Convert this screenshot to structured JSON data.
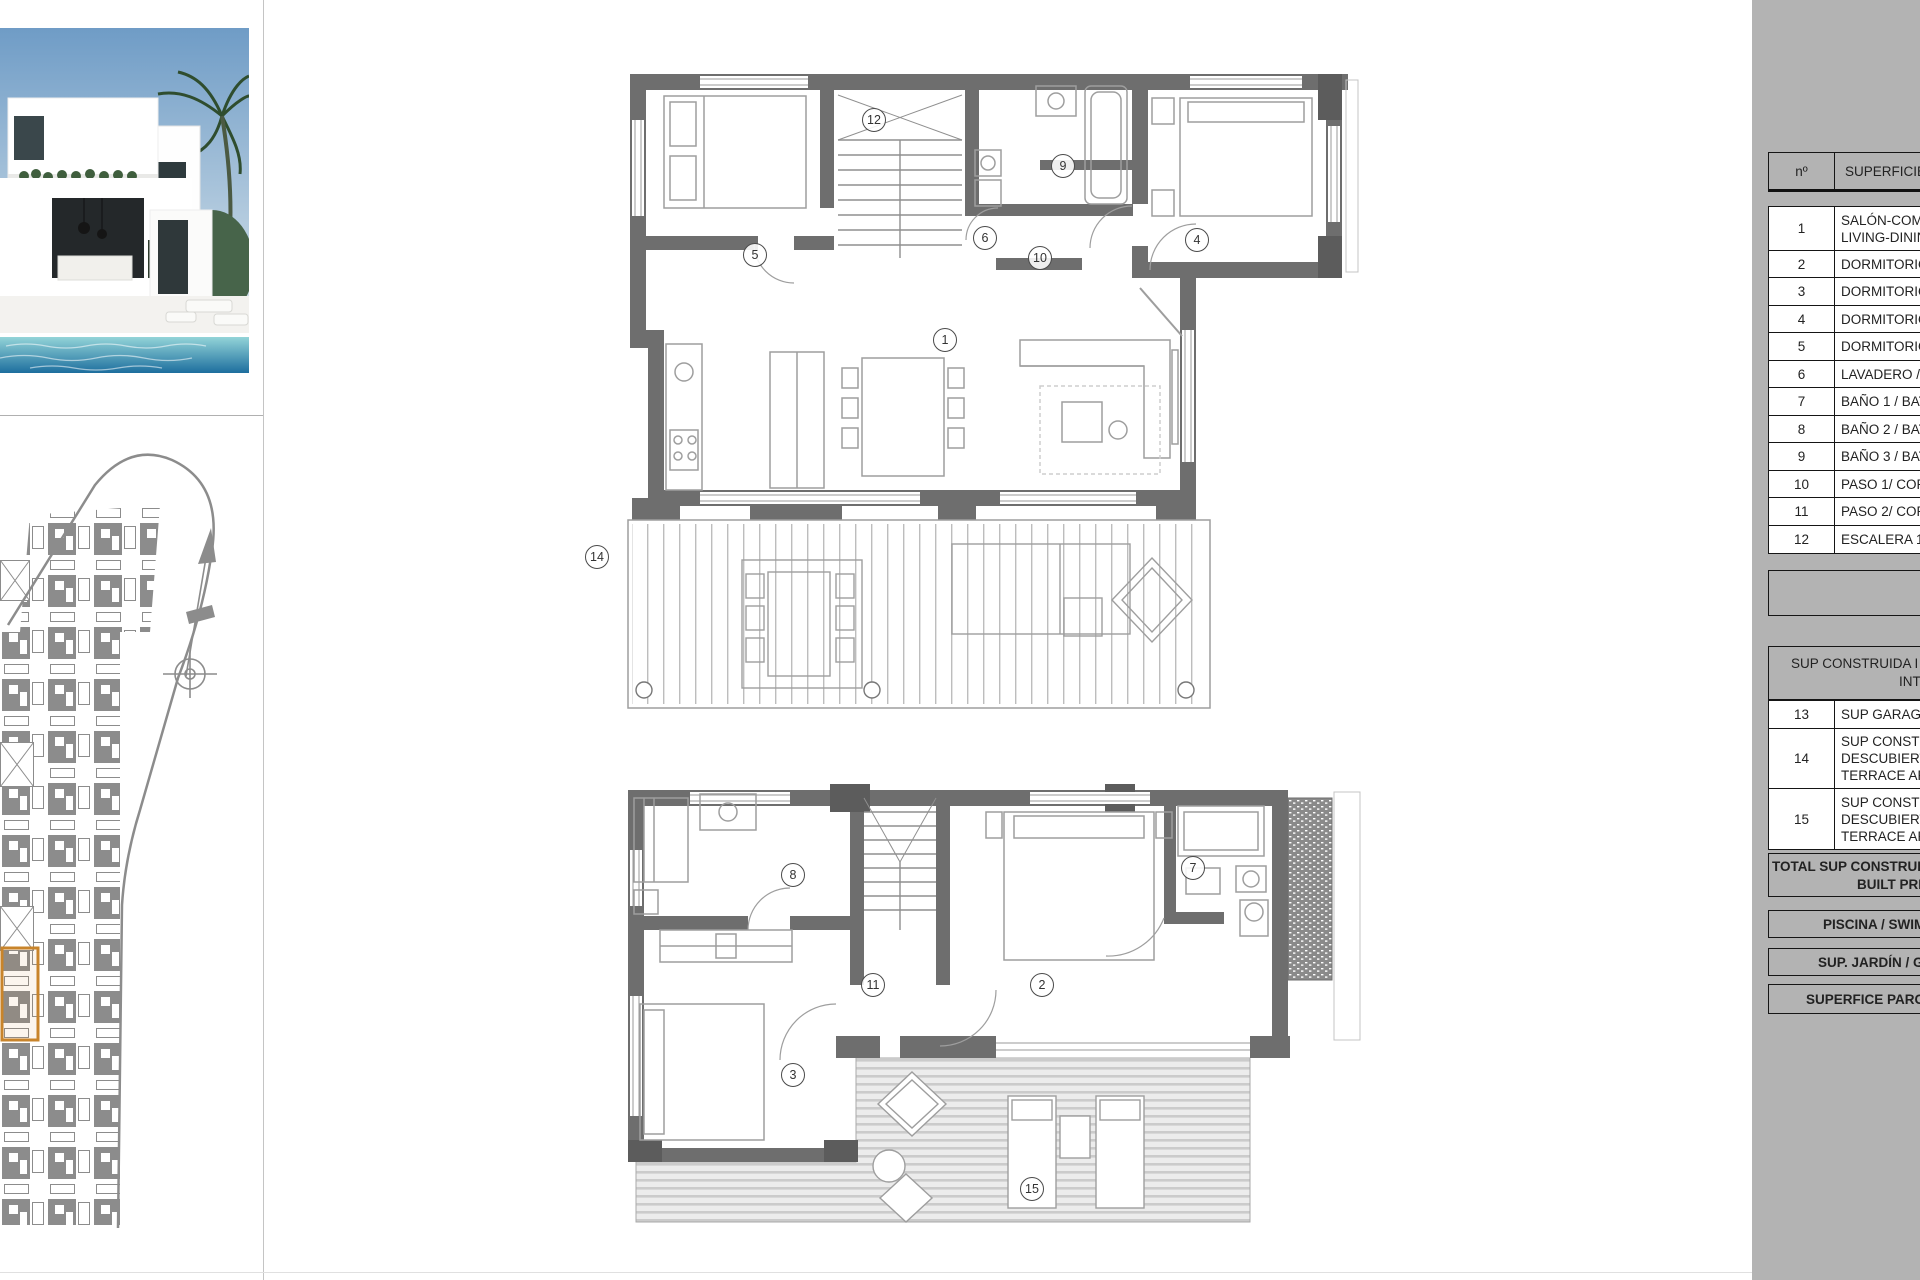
{
  "document": {
    "kind": "architectural plan sheet"
  },
  "photo": {
    "description": "modern white villa render with pool and palm"
  },
  "site_plan": {
    "highlight_color": "#c8842b"
  },
  "plans": {
    "upper": {
      "labels": [
        "12",
        "9",
        "6",
        "10",
        "4",
        "5",
        "1",
        "14"
      ]
    },
    "ground": {
      "labels": [
        "8",
        "7",
        "11",
        "2",
        "3",
        "15"
      ]
    }
  },
  "table": {
    "header": {
      "num": "nº",
      "label": "SUPERFICIE Ú"
    },
    "rooms": [
      {
        "num": "1",
        "lines": [
          "SALÓN-COM",
          "LIVING-DININ"
        ]
      },
      {
        "num": "2",
        "lines": [
          "DORMITORIO"
        ]
      },
      {
        "num": "3",
        "lines": [
          "DORMITORIO"
        ]
      },
      {
        "num": "4",
        "lines": [
          "DORMITORIO"
        ]
      },
      {
        "num": "5",
        "lines": [
          "DORMITORIO"
        ]
      },
      {
        "num": "6",
        "lines": [
          "LAVADERO /"
        ]
      },
      {
        "num": "7",
        "lines": [
          "BAÑO 1 / BAT"
        ]
      },
      {
        "num": "8",
        "lines": [
          "BAÑO 2 / BAT"
        ]
      },
      {
        "num": "9",
        "lines": [
          "BAÑO 3 / BAT"
        ]
      },
      {
        "num": "10",
        "lines": [
          "PASO 1/ COR"
        ]
      },
      {
        "num": "11",
        "lines": [
          "PASO 2/ COR"
        ]
      },
      {
        "num": "12",
        "lines": [
          "ESCALERA 1 /"
        ]
      }
    ],
    "section_header": {
      "l1": "SUP CONSTRUIDA I",
      "l2": "INTERIOR"
    },
    "areas": [
      {
        "num": "13",
        "lines": [
          "SUP GARAGE"
        ]
      },
      {
        "num": "14",
        "lines": [
          "SUP CONSTRU",
          "DESCUBIERTA",
          "TERRACE ARE"
        ]
      },
      {
        "num": "15",
        "lines": [
          "SUP CONSTRU",
          "DESCUBIERTA",
          "TERRACE ARE"
        ]
      }
    ],
    "total": {
      "l1": "TOTAL SUP CONSTRUID",
      "l2": "BUILT PRIVA"
    },
    "bands": [
      "PISCINA / SWIM",
      "SUP. JARDÍN / G",
      "SUPERFICE PARCE"
    ]
  }
}
